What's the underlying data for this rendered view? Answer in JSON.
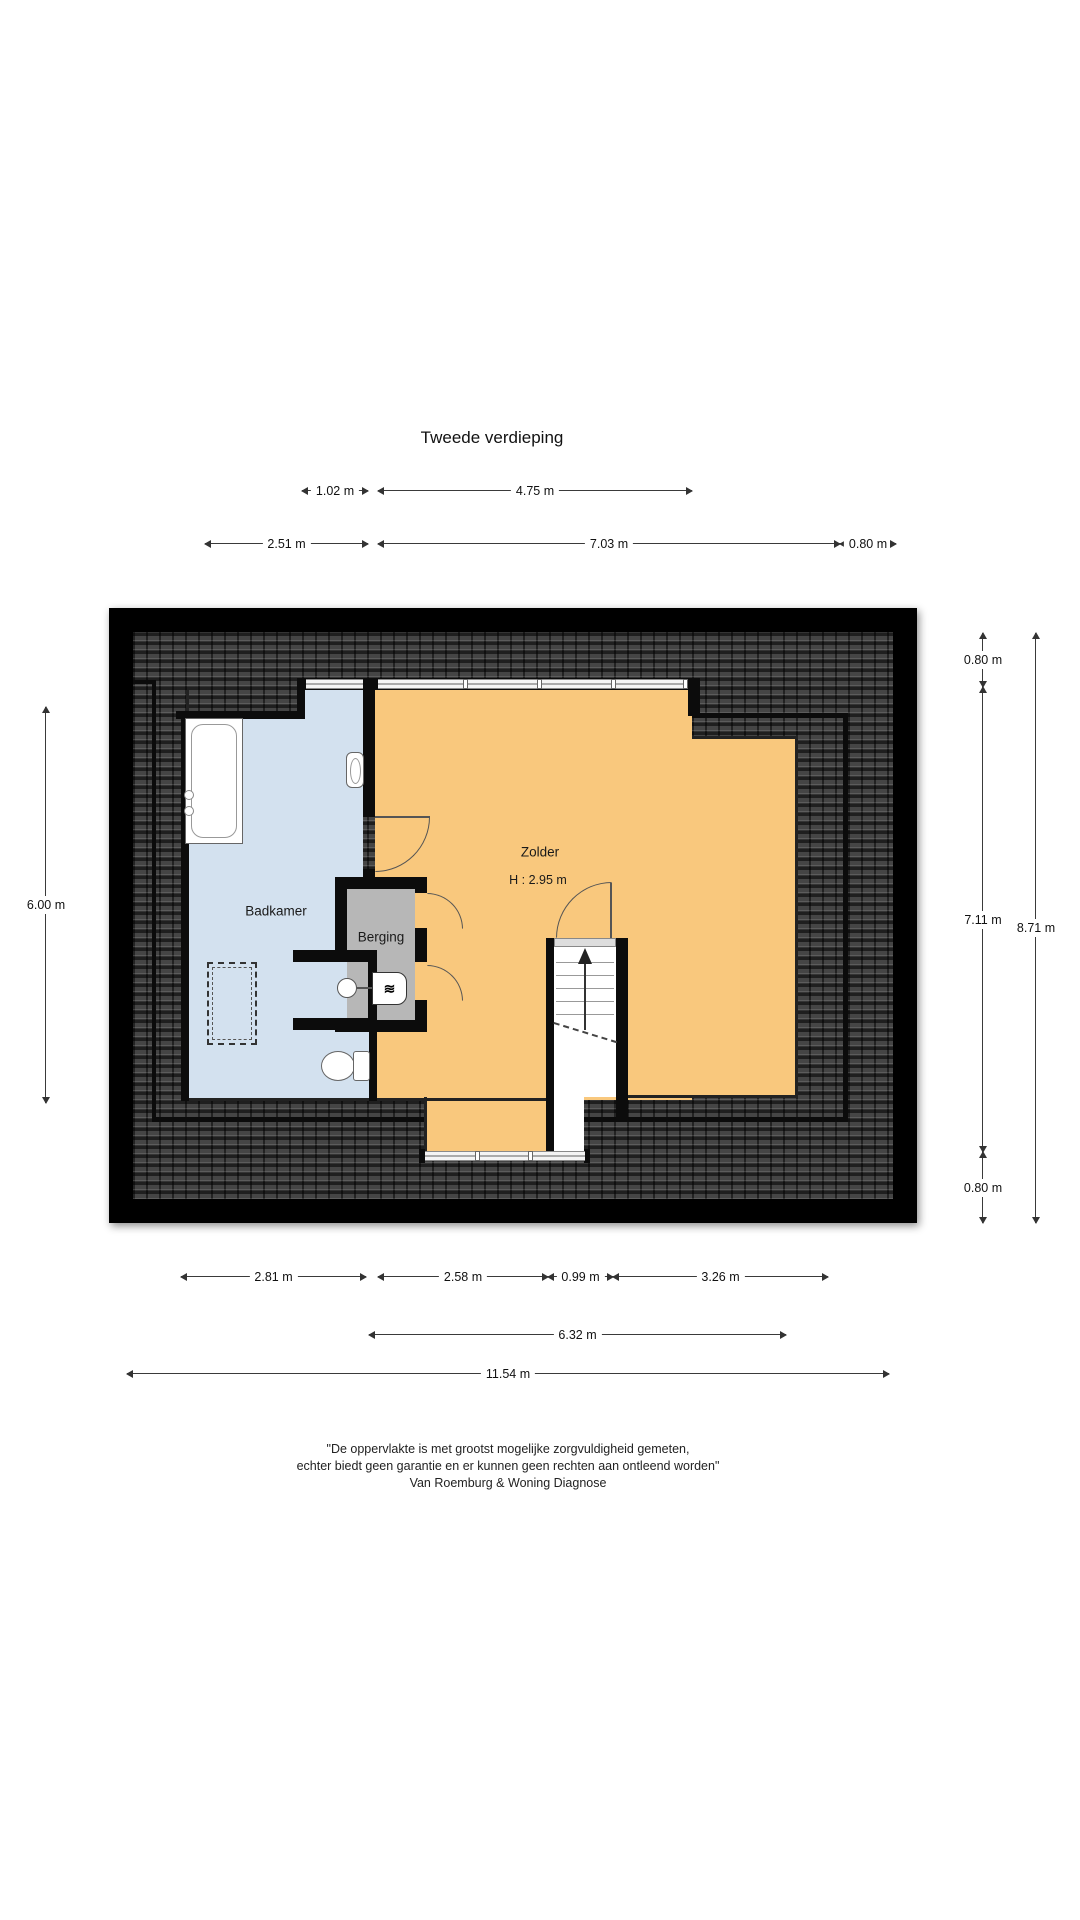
{
  "title": "Tweede verdieping",
  "dims": {
    "t102": "1.02 m",
    "t475": "4.75 m",
    "t251": "2.51 m",
    "t703": "7.03 m",
    "t080": "0.80 m",
    "l600": "6.00 m",
    "r080a": "0.80 m",
    "r711": "7.11 m",
    "r871": "8.71 m",
    "r080b": "0.80 m",
    "b281": "2.81 m",
    "b258": "2.58 m",
    "b099": "0.99 m",
    "b326": "3.26 m",
    "b632": "6.32 m",
    "b1154": "11.54 m"
  },
  "rooms": {
    "badkamer": {
      "label": "Badkamer"
    },
    "berging": {
      "label": "Berging"
    },
    "zolder": {
      "label": "Zolder",
      "ceiling_height": "H : 2.95 m"
    }
  },
  "fixtures": {
    "washer_icon": "≋"
  },
  "footer": {
    "line1": "\"De oppervlakte is met grootst mogelijke zorgvuldigheid gemeten,",
    "line2": "echter biedt geen garantie en er kunnen geen rechten aan ontleend worden\"",
    "line3": "Van Roemburg & Woning Diagnose"
  },
  "colors": {
    "roof": "#454545",
    "wall": "#0c0c0c",
    "badkamer": "#d3e1ef",
    "zolder": "#f9c87d",
    "berging": "#b7b7b7"
  }
}
